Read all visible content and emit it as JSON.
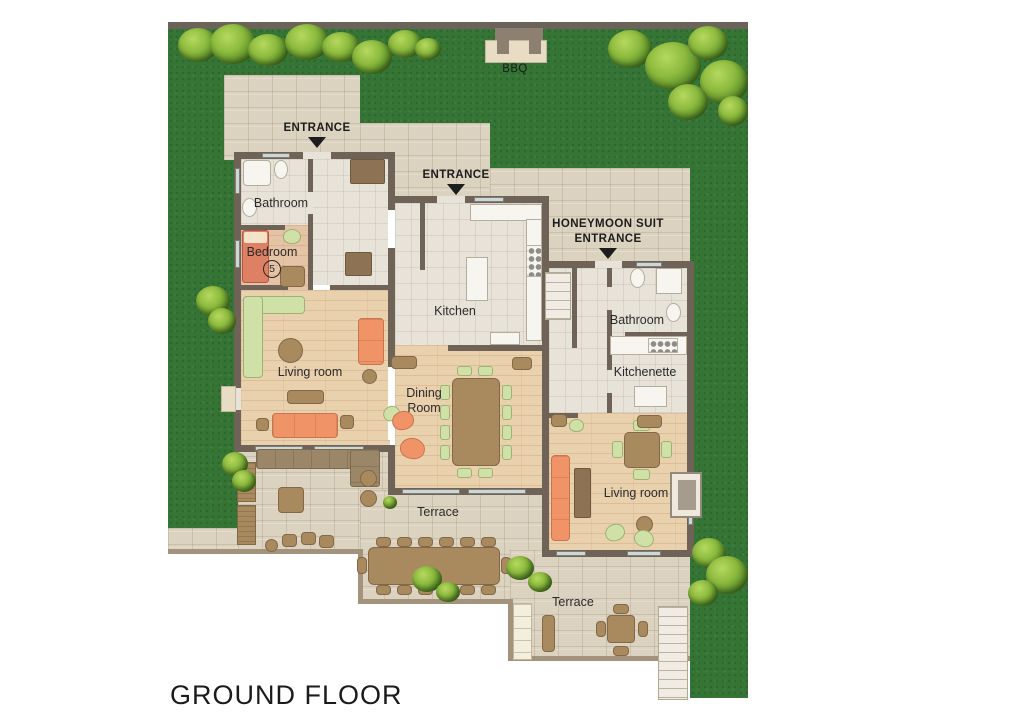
{
  "title": "GROUND FLOOR",
  "colors": {
    "grass": "#347434",
    "stone": "#dcd2c0",
    "wall": "#6f6358",
    "wood_floor": "#ead1ae",
    "tile_floor": "#e8e3d9",
    "accent_orange": "#f09468",
    "accent_green": "#cfe1a7",
    "furniture_brown": "#a98a5f",
    "window": "#ccd8d8",
    "label_text": "#2a2a2a"
  },
  "garden": {
    "bbq_label": "BBQ"
  },
  "entrances": {
    "left_label": "ENTRANCE",
    "main_label": "ENTRANCE",
    "honeymoon_line1": "HONEYMOON SUIT",
    "honeymoon_line2": "ENTRANCE"
  },
  "main_unit": {
    "bathroom_label": "Bathroom",
    "bedroom_label": "Bedroom",
    "bedroom_number": "5",
    "kitchen_label": "Kitchen",
    "living_room_label": "Living room",
    "dining_room_line1": "Dining",
    "dining_room_line2": "Room"
  },
  "honeymoon_suite": {
    "bathroom_label": "Bathroom",
    "kitchenette_label": "Kitchenette",
    "living_room_label": "Living room"
  },
  "terraces": {
    "main_label": "Terrace",
    "suite_label": "Terrace"
  }
}
